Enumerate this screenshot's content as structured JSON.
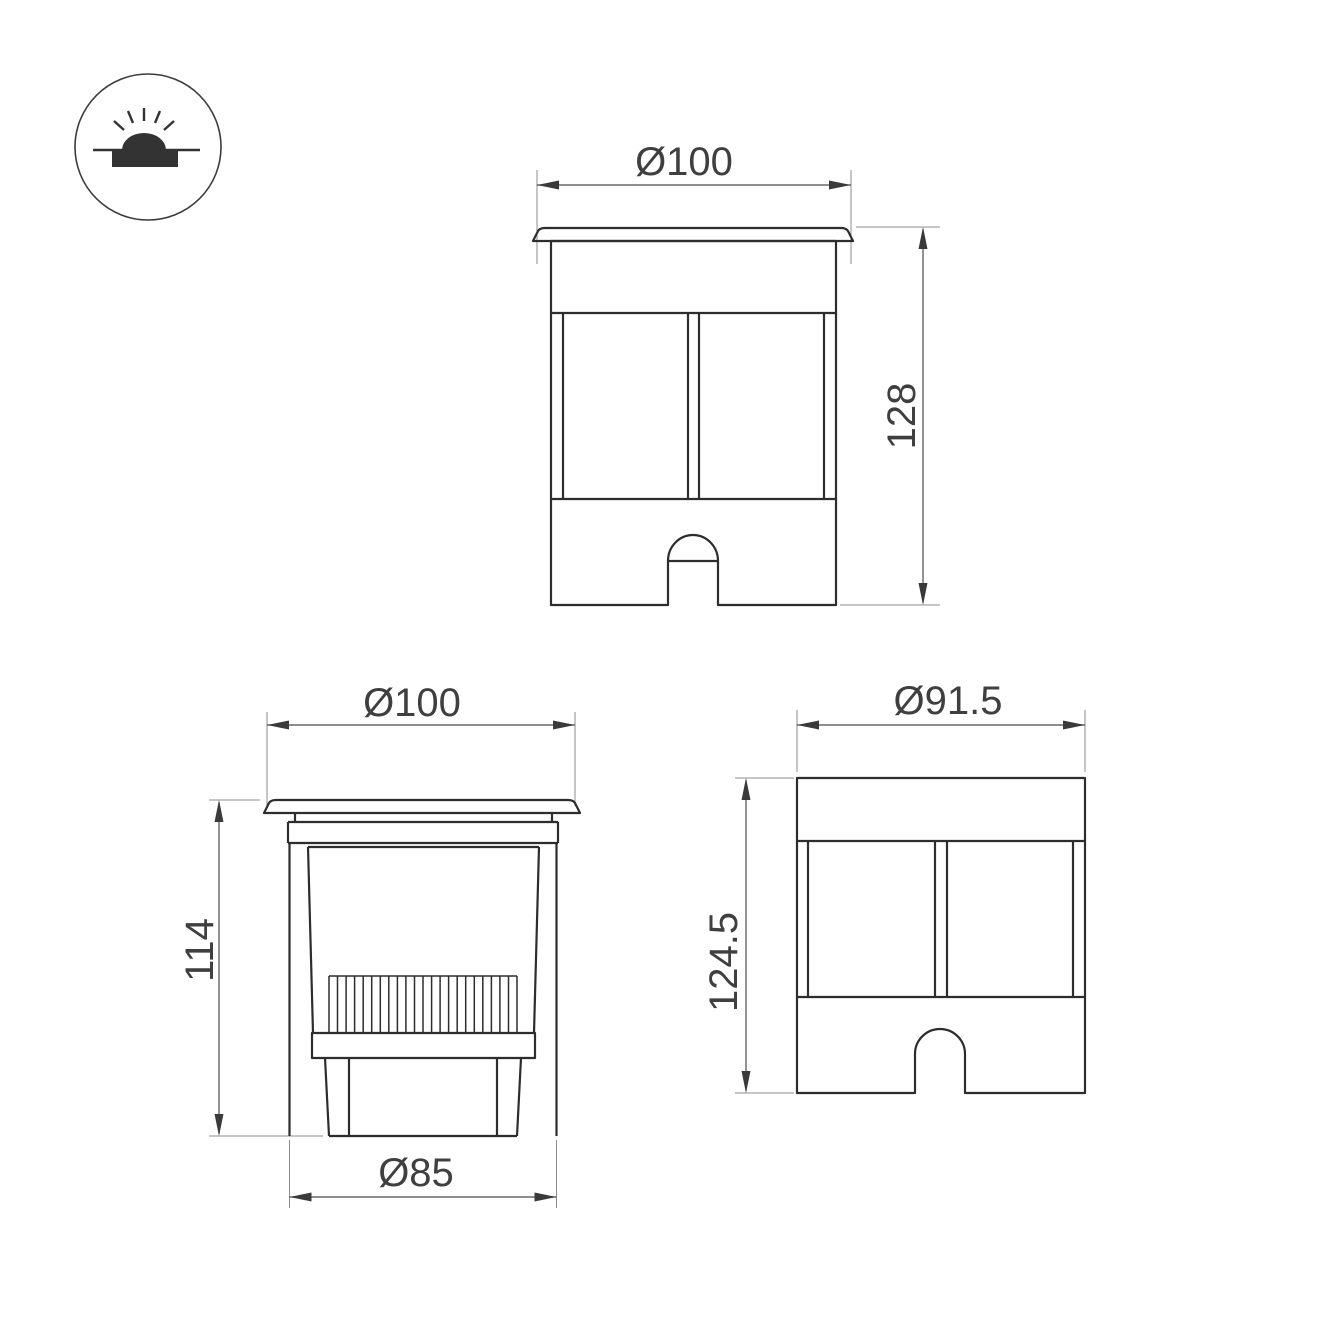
{
  "drawing": {
    "type": "technical-dimension-drawing",
    "icon": {
      "name": "recessed-inground-luminaire-icon"
    },
    "views": {
      "front": {
        "diameter": "Ø100",
        "height": "128"
      },
      "section": {
        "diameter_top": "Ø100",
        "height": "114",
        "diameter_body": "Ø85"
      },
      "rear": {
        "diameter": "Ø91.5",
        "height": "124.5"
      }
    },
    "colors": {
      "outline": "#2d2d2d",
      "dimension_line": "#4a4a4a",
      "extension_line": "#8d8d8d",
      "text": "#3f3f3f",
      "background": "#ffffff"
    }
  }
}
